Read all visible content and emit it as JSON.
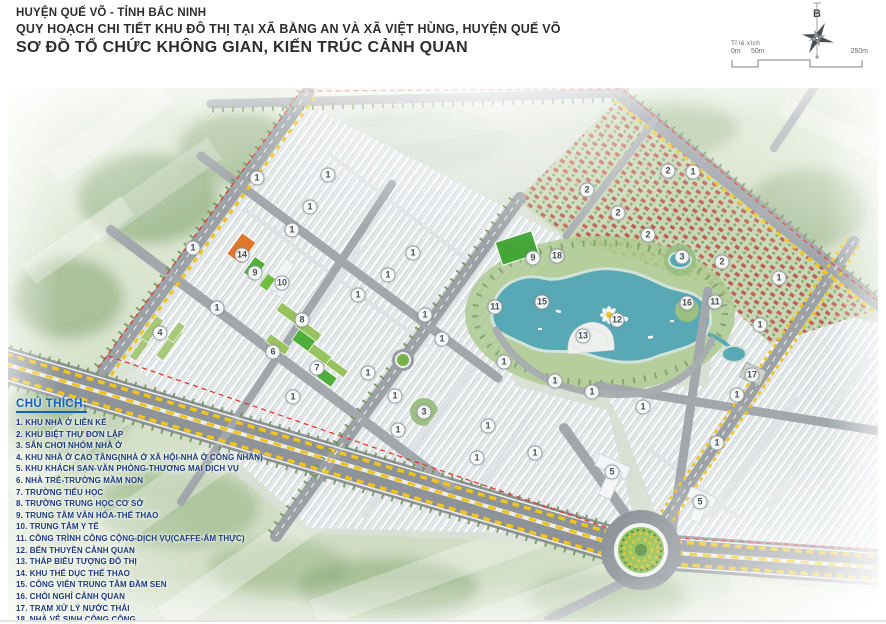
{
  "header": {
    "line1": "HUYỆN QUẾ VÕ - TỈNH BẮC NINH",
    "line2": "QUY HOẠCH CHI TIẾT KHU ĐÔ THỊ TẠI XÃ BẰNG AN VÀ XÃ VIỆT HÙNG, HUYỆN QUẾ VÕ",
    "line3": "SƠ ĐỒ TỔ CHỨC KHÔNG GIAN, KIẾN TRÚC CẢNH QUAN"
  },
  "compass": {
    "north_label": "B"
  },
  "scalebar": {
    "label": "Tỉ lệ xích",
    "ticks": [
      "0m",
      "50m",
      "250m"
    ]
  },
  "legend": {
    "title": "CHÚ THÍCH:",
    "items": [
      "1. KHU NHÀ Ở LIÊN KẾ",
      "2. KHU BIỆT THỰ ĐƠN LẬP",
      "3. SÂN CHƠI NHÓM NHÀ Ở",
      "4. KHU NHÀ Ở CAO TẦNG(NHÀ Ở XÃ HỘI-NHÀ Ở CÔNG NHÂN)",
      "5. KHU KHÁCH SẠN-VĂN PHÒNG-THƯƠNG MẠI DỊCH VỤ",
      "6. NHÀ TRẺ-TRƯỜNG MẦM NON",
      "7. TRƯỜNG TIỂU HỌC",
      "8. TRƯỜNG TRUNG HỌC CƠ SỞ",
      "9. TRUNG TÂM VĂN HÓA-THỂ THAO",
      "10. TRUNG TÂM Y TẾ",
      "11. CÔNG TRÌNH CÔNG CỘNG-DỊCH VỤ(CAFFE-ẨM THỰC)",
      "12. BẾN THUYỀN CẢNH QUAN",
      "13. THÁP BIỂU TƯỢNG ĐÔ THỊ",
      "14. KHU THỂ DỤC THỂ THAO",
      "15. CÔNG VIÊN TRUNG TÂM ĐẦM SEN",
      "16. CHÒI NGHỈ CẢNH QUAN",
      "17. TRẠM XỬ LÝ NƯỚC THẢI",
      "18. NHÀ VỆ SINH CÔNG CỘNG"
    ]
  },
  "map": {
    "colors": {
      "road": "#8d9398",
      "road_minor": "#a2a7ab",
      "lane_yellow": "#f0c419",
      "boundary_red": "#e0392e",
      "lake": "#58a8b6",
      "park": "#aecb92",
      "field_green": "#44a636",
      "villa_roof": "#c05a49",
      "orange_roof": "#e0762c",
      "legend_blue": "#1d3c7e",
      "legend_title_blue": "#0f62c5"
    },
    "markers": [
      {
        "n": "1",
        "x": 249,
        "y": 90
      },
      {
        "n": "1",
        "x": 320,
        "y": 87
      },
      {
        "n": "1",
        "x": 302,
        "y": 119
      },
      {
        "n": "1",
        "x": 284,
        "y": 142
      },
      {
        "n": "1",
        "x": 185,
        "y": 160
      },
      {
        "n": "1",
        "x": 209,
        "y": 220
      },
      {
        "n": "1",
        "x": 350,
        "y": 207
      },
      {
        "n": "1",
        "x": 380,
        "y": 187
      },
      {
        "n": "1",
        "x": 405,
        "y": 165
      },
      {
        "n": "1",
        "x": 360,
        "y": 285
      },
      {
        "n": "1",
        "x": 285,
        "y": 309
      },
      {
        "n": "1",
        "x": 387,
        "y": 308
      },
      {
        "n": "1",
        "x": 390,
        "y": 342
      },
      {
        "n": "1",
        "x": 417,
        "y": 227
      },
      {
        "n": "1",
        "x": 434,
        "y": 251
      },
      {
        "n": "1",
        "x": 480,
        "y": 338
      },
      {
        "n": "1",
        "x": 496,
        "y": 274
      },
      {
        "n": "1",
        "x": 527,
        "y": 365
      },
      {
        "n": "1",
        "x": 547,
        "y": 293
      },
      {
        "n": "1",
        "x": 469,
        "y": 370
      },
      {
        "n": "1",
        "x": 584,
        "y": 304
      },
      {
        "n": "1",
        "x": 635,
        "y": 319
      },
      {
        "n": "1",
        "x": 685,
        "y": 84
      },
      {
        "n": "1",
        "x": 752,
        "y": 237
      },
      {
        "n": "1",
        "x": 729,
        "y": 307
      },
      {
        "n": "1",
        "x": 771,
        "y": 190
      },
      {
        "n": "1",
        "x": 709,
        "y": 355
      },
      {
        "n": "2",
        "x": 579,
        "y": 102
      },
      {
        "n": "2",
        "x": 610,
        "y": 125
      },
      {
        "n": "2",
        "x": 640,
        "y": 147
      },
      {
        "n": "2",
        "x": 660,
        "y": 83
      },
      {
        "n": "2",
        "x": 714,
        "y": 174
      },
      {
        "n": "3",
        "x": 674,
        "y": 169
      },
      {
        "n": "3",
        "x": 416,
        "y": 324
      },
      {
        "n": "4",
        "x": 152,
        "y": 245
      },
      {
        "n": "5",
        "x": 604,
        "y": 384
      },
      {
        "n": "5",
        "x": 692,
        "y": 414
      },
      {
        "n": "6",
        "x": 265,
        "y": 264
      },
      {
        "n": "7",
        "x": 309,
        "y": 280
      },
      {
        "n": "8",
        "x": 294,
        "y": 232
      },
      {
        "n": "9",
        "x": 247,
        "y": 185
      },
      {
        "n": "9",
        "x": 525,
        "y": 170
      },
      {
        "n": "10",
        "x": 274,
        "y": 195
      },
      {
        "n": "11",
        "x": 487,
        "y": 219
      },
      {
        "n": "11",
        "x": 707,
        "y": 214
      },
      {
        "n": "12",
        "x": 609,
        "y": 232
      },
      {
        "n": "13",
        "x": 575,
        "y": 248
      },
      {
        "n": "14",
        "x": 234,
        "y": 167
      },
      {
        "n": "15",
        "x": 534,
        "y": 214
      },
      {
        "n": "16",
        "x": 679,
        "y": 215
      },
      {
        "n": "17",
        "x": 744,
        "y": 287
      },
      {
        "n": "18",
        "x": 549,
        "y": 168
      }
    ]
  }
}
